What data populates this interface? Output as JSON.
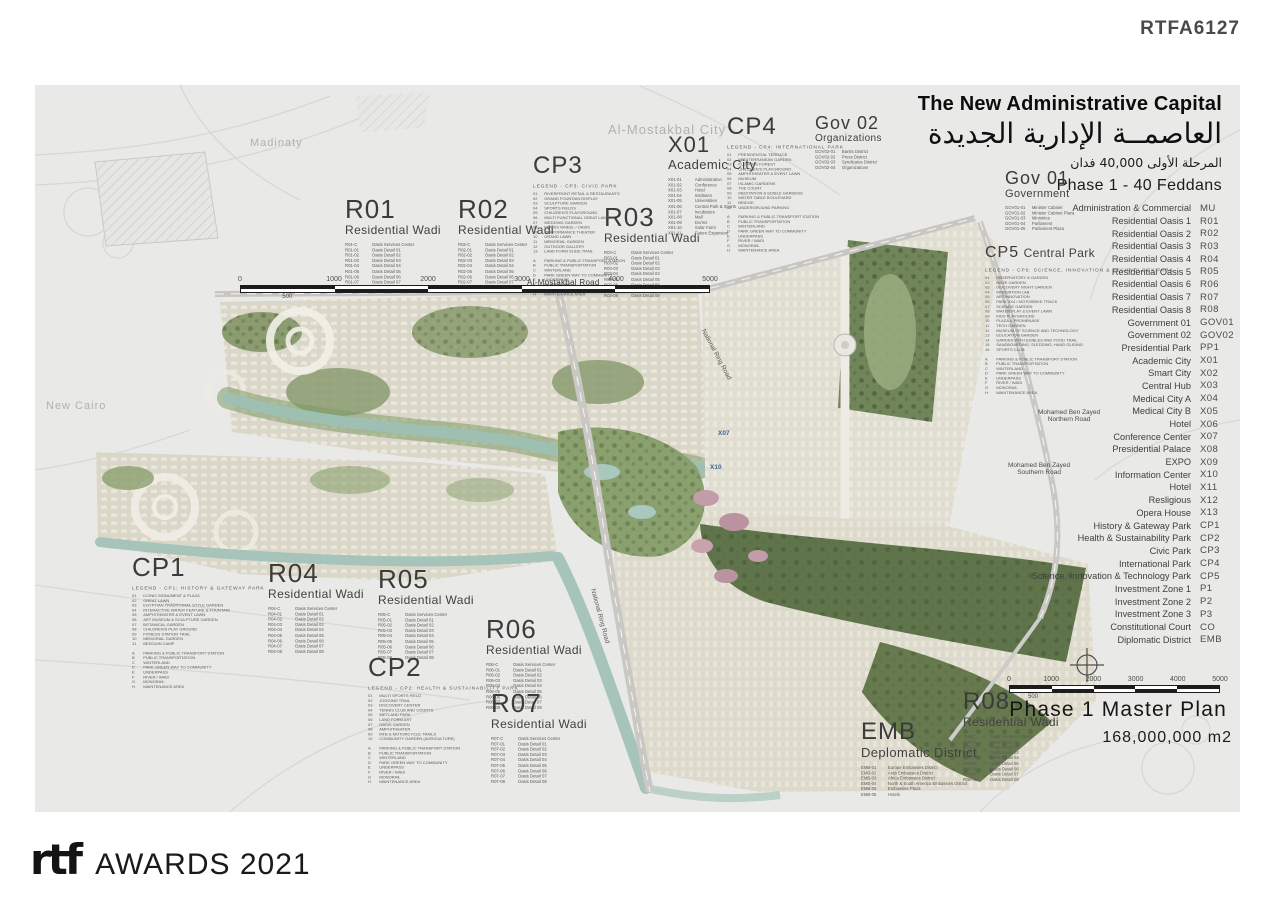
{
  "ref_code": "RTFA6127",
  "title": {
    "en": "The New Administrative Capital",
    "ar": "العاصمــة الإدارية الجديدة",
    "ar_sub": "المرحلة الأولى 40,000 فدان",
    "phase": "Phase 1 - 40 Feddans"
  },
  "context_labels": {
    "madinaty": "Madinaty",
    "almostakbal_city": "Al-Mostakbal City",
    "new_cairo": "New Cairo"
  },
  "roads": {
    "almostakbal_road": "Al-Mostakbal Road",
    "mbz_north_1": "Mohamed Ben Zayed",
    "mbz_north_2": "Northern Road",
    "mbz_south_1": "Mohamed Ben Zayed",
    "mbz_south_2": "Southern Road",
    "national_ring_1": "National Ring Road",
    "national_ring_2": "National Ring Road"
  },
  "map_codes": [
    {
      "label": "X07"
    },
    {
      "label": "X10"
    }
  ],
  "key_legend": [
    {
      "name": "Administration & Commercial",
      "code": "MU"
    },
    {
      "name": "Residential Oasis 1",
      "code": "R01"
    },
    {
      "name": "Residential Oasis 2",
      "code": "R02"
    },
    {
      "name": "Residential Oasis 3",
      "code": "R03"
    },
    {
      "name": "Residential Oasis 4",
      "code": "R04"
    },
    {
      "name": "Residential Oasis 5",
      "code": "R05"
    },
    {
      "name": "Residential Oasis 6",
      "code": "R06"
    },
    {
      "name": "Residential Oasis 7",
      "code": "R07"
    },
    {
      "name": "Residential Oasis 8",
      "code": "R08"
    },
    {
      "name": "Government 01",
      "code": "GOV01"
    },
    {
      "name": "Government 02",
      "code": "GOV02"
    },
    {
      "name": "Presidential Park",
      "code": "PP1"
    },
    {
      "name": "Academic City",
      "code": "X01"
    },
    {
      "name": "Smart City",
      "code": "X02"
    },
    {
      "name": "Central Hub",
      "code": "X03"
    },
    {
      "name": "Medical City A",
      "code": "X04"
    },
    {
      "name": "Medical City B",
      "code": "X05"
    },
    {
      "name": "Hotel",
      "code": "X06"
    },
    {
      "name": "Conference Center",
      "code": "X07"
    },
    {
      "name": "Presidential Palace",
      "code": "X08"
    },
    {
      "name": "EXPO",
      "code": "X09"
    },
    {
      "name": "Information Center",
      "code": "X10"
    },
    {
      "name": "Hotel",
      "code": "X11"
    },
    {
      "name": "Resligious",
      "code": "X12"
    },
    {
      "name": "Opera House",
      "code": "X13"
    },
    {
      "name": "History & Gateway Park",
      "code": "CP1"
    },
    {
      "name": "Health & Sustainability Park",
      "code": "CP2"
    },
    {
      "name": "Civic Park",
      "code": "CP3"
    },
    {
      "name": "International Park",
      "code": "CP4"
    },
    {
      "name": "Science, Innovation & Technology Park",
      "code": "CP5"
    },
    {
      "name": "Investment Zone 1",
      "code": "P1"
    },
    {
      "name": "Investment Zone 2",
      "code": "P2"
    },
    {
      "name": "Investment Zone 3",
      "code": "P3"
    },
    {
      "name": "Constitutional Court",
      "code": "CO"
    },
    {
      "name": "Diplomatic District",
      "code": "EMB"
    }
  ],
  "districts": {
    "r01": {
      "code": "R01",
      "subtitle": "Residential Wadi",
      "items": [
        {
          "c": "R01-C",
          "n": "Oasis Services Center"
        },
        {
          "c": "R01-01",
          "n": "Oasis Detail 01"
        },
        {
          "c": "R01-02",
          "n": "Oasis Detail 02"
        },
        {
          "c": "R01-03",
          "n": "Oasis Detail 03"
        },
        {
          "c": "R01-04",
          "n": "Oasis Detail 04"
        },
        {
          "c": "R01-05",
          "n": "Oasis Detail 05"
        },
        {
          "c": "R01-06",
          "n": "Oasis Detail 06"
        },
        {
          "c": "R01-07",
          "n": "Oasis Detail 07"
        },
        {
          "c": "R01-08",
          "n": "Oasis Detail 08"
        }
      ]
    },
    "r02": {
      "code": "R02",
      "subtitle": "Residential Wadi",
      "items": [
        {
          "c": "R02-C",
          "n": "Oasis Services Center"
        },
        {
          "c": "R02-01",
          "n": "Oasis Detail 01"
        },
        {
          "c": "R02-02",
          "n": "Oasis Detail 02"
        },
        {
          "c": "R02-03",
          "n": "Oasis Detail 03"
        },
        {
          "c": "R02-04",
          "n": "Oasis Detail 04"
        },
        {
          "c": "R02-05",
          "n": "Oasis Detail 05"
        },
        {
          "c": "R02-06",
          "n": "Oasis Detail 06"
        },
        {
          "c": "R02-07",
          "n": "Oasis Detail 07"
        },
        {
          "c": "R02-08",
          "n": "Oasis Detail 08"
        }
      ]
    },
    "r03": {
      "code": "R03",
      "subtitle": "Residential Wadi",
      "items": [
        {
          "c": "R03-C",
          "n": "Oasis Services Center"
        },
        {
          "c": "R03-01",
          "n": "Oasis Detail 01"
        },
        {
          "c": "R03-02",
          "n": "Oasis Detail 02"
        },
        {
          "c": "R03-03",
          "n": "Oasis Detail 03"
        },
        {
          "c": "R03-04",
          "n": "Oasis Detail 04"
        },
        {
          "c": "R03-05",
          "n": "Oasis Detail 05"
        },
        {
          "c": "R03-06",
          "n": "Oasis Detail 06"
        },
        {
          "c": "R03-07",
          "n": "Oasis Detail 07"
        },
        {
          "c": "R03-08",
          "n": "Oasis Detail 08"
        }
      ]
    },
    "r04": {
      "code": "R04",
      "subtitle": "Residential Wadi",
      "items": [
        {
          "c": "R04-C",
          "n": "Oasis Services Center"
        },
        {
          "c": "R04-01",
          "n": "Oasis Detail 01"
        },
        {
          "c": "R04-02",
          "n": "Oasis Detail 02"
        },
        {
          "c": "R04-03",
          "n": "Oasis Detail 03"
        },
        {
          "c": "R04-04",
          "n": "Oasis Detail 04"
        },
        {
          "c": "R04-05",
          "n": "Oasis Detail 05"
        },
        {
          "c": "R04-06",
          "n": "Oasis Detail 06"
        },
        {
          "c": "R04-07",
          "n": "Oasis Detail 07"
        },
        {
          "c": "R04-08",
          "n": "Oasis Detail 08"
        }
      ]
    },
    "r05": {
      "code": "R05",
      "subtitle": "Residential Wadi",
      "items": [
        {
          "c": "R05-C",
          "n": "Oasis Services Center"
        },
        {
          "c": "R05-01",
          "n": "Oasis Detail 01"
        },
        {
          "c": "R05-02",
          "n": "Oasis Detail 02"
        },
        {
          "c": "R05-03",
          "n": "Oasis Detail 03"
        },
        {
          "c": "R05-04",
          "n": "Oasis Detail 04"
        },
        {
          "c": "R05-05",
          "n": "Oasis Detail 05"
        },
        {
          "c": "R05-06",
          "n": "Oasis Detail 06"
        },
        {
          "c": "R05-07",
          "n": "Oasis Detail 07"
        },
        {
          "c": "R05-08",
          "n": "Oasis Detail 08"
        }
      ]
    },
    "r06": {
      "code": "R06",
      "subtitle": "Residential Wadi",
      "items": [
        {
          "c": "R06-C",
          "n": "Oasis Services Center"
        },
        {
          "c": "R06-01",
          "n": "Oasis Detail 01"
        },
        {
          "c": "R06-02",
          "n": "Oasis Detail 02"
        },
        {
          "c": "R06-03",
          "n": "Oasis Detail 03"
        },
        {
          "c": "R06-04",
          "n": "Oasis Detail 04"
        },
        {
          "c": "R06-05",
          "n": "Oasis Detail 05"
        },
        {
          "c": "R06-06",
          "n": "Oasis Detail 06"
        },
        {
          "c": "R06-07",
          "n": "Oasis Detail 07"
        },
        {
          "c": "R06-08",
          "n": "Oasis Detail 08"
        }
      ]
    },
    "r07": {
      "code": "R07",
      "subtitle": "Residential Wadi",
      "items": [
        {
          "c": "R07-C",
          "n": "Oasis Services Center"
        },
        {
          "c": "R07-01",
          "n": "Oasis Detail 01"
        },
        {
          "c": "R07-02",
          "n": "Oasis Detail 02"
        },
        {
          "c": "R07-03",
          "n": "Oasis Detail 03"
        },
        {
          "c": "R07-04",
          "n": "Oasis Detail 04"
        },
        {
          "c": "R07-05",
          "n": "Oasis Detail 05"
        },
        {
          "c": "R07-06",
          "n": "Oasis Detail 06"
        },
        {
          "c": "R07-07",
          "n": "Oasis Detail 07"
        },
        {
          "c": "R07-08",
          "n": "Oasis Detail 08"
        }
      ]
    },
    "r08": {
      "code": "R08",
      "subtitle": "Residential Wadi",
      "items": [
        {
          "c": "R08-C",
          "n": "Oasis Services Center"
        },
        {
          "c": "R08-01",
          "n": "Oasis Detail 01"
        },
        {
          "c": "R08-02",
          "n": "Oasis Detail 02"
        },
        {
          "c": "R08-03",
          "n": "Oasis Detail 03"
        },
        {
          "c": "R08-04",
          "n": "Oasis Detail 04"
        },
        {
          "c": "R08-05",
          "n": "Oasis Detail 05"
        },
        {
          "c": "R08-06",
          "n": "Oasis Detail 06"
        },
        {
          "c": "R08-07",
          "n": "Oasis Detail 07"
        },
        {
          "c": "R08-08",
          "n": "Oasis Detail 08"
        }
      ]
    },
    "x01": {
      "code": "X01",
      "subtitle": "Academic City",
      "items": [
        {
          "c": "X01-01",
          "n": "Administration"
        },
        {
          "c": "X01-02",
          "n": "Conference"
        },
        {
          "c": "X01-03",
          "n": "Hotel"
        },
        {
          "c": "X01-04",
          "n": "Institutes"
        },
        {
          "c": "X01-05",
          "n": "Universities"
        },
        {
          "c": "X01-06",
          "n": "Central Park & Sports"
        },
        {
          "c": "X01-07",
          "n": "Incubators"
        },
        {
          "c": "X01-08",
          "n": "Mall"
        },
        {
          "c": "X01-09",
          "n": "Dorms"
        },
        {
          "c": "X01-10",
          "n": "Solar Farm"
        },
        {
          "c": "X01-11",
          "n": "Future Expansion"
        }
      ]
    },
    "gov01": {
      "code": "Gov 01",
      "subtitle": "Government",
      "items": [
        {
          "c": "GOV01-01",
          "n": "Minister Cabinet"
        },
        {
          "c": "GOV01-02",
          "n": "Minister Cabinet Plaza"
        },
        {
          "c": "GOV01-03",
          "n": "Ministries"
        },
        {
          "c": "GOV01-04",
          "n": "Parliament"
        },
        {
          "c": "GOV01-05",
          "n": "Parliament Plaza"
        }
      ]
    },
    "gov02": {
      "code": "Gov 02",
      "subtitle": "Organizations",
      "items": [
        {
          "c": "GOV02-01",
          "n": "Banks District"
        },
        {
          "c": "GOV02-02",
          "n": "Press District"
        },
        {
          "c": "GOV02-03",
          "n": "Syndicates District"
        },
        {
          "c": "GOV02-04",
          "n": "Organizations"
        }
      ]
    },
    "emb": {
      "code": "EMB",
      "subtitle": "Deplomatic District",
      "items": [
        {
          "c": "EMB-01",
          "n": "Europe Embassies District"
        },
        {
          "c": "EMB-02",
          "n": "Arab Embassies District"
        },
        {
          "c": "EMB-03",
          "n": "Africa Embassies District"
        },
        {
          "c": "EMB-04",
          "n": "North & South America Embassies District"
        },
        {
          "c": "EMB-05",
          "n": "Embassies Plaza"
        },
        {
          "c": "EMB-06",
          "n": "Hotels"
        }
      ]
    }
  },
  "parks": {
    "cp1": {
      "code": "CP1",
      "header": "LEGEND - CP1: HISTORY & GATEWAY PARK",
      "items": [
        {
          "c": "01",
          "n": "ICONIC MONUMENT & PLAZA"
        },
        {
          "c": "02",
          "n": "GREAT LAWN"
        },
        {
          "c": "03",
          "n": "EGYPTIAN TRADITIONAL STYLE GARDEN"
        },
        {
          "c": "04",
          "n": "INTERACTIVE WATER FEATURE & FOUNTAIN"
        },
        {
          "c": "05",
          "n": "AMPHITHEATER & EVENT LAWN"
        },
        {
          "c": "06",
          "n": "ART MUSEUM & SCULPTURE GARDEN"
        },
        {
          "c": "07",
          "n": "BOTANICAL GARDEN"
        },
        {
          "c": "08",
          "n": "CHILDREN'S PLAY GROUND"
        },
        {
          "c": "09",
          "n": "FITNESS STATION TRAIL"
        },
        {
          "c": "10",
          "n": "MEMORIAL GARDEN"
        },
        {
          "c": "11",
          "n": "BEDOUIN CAMP"
        }
      ]
    },
    "cp2": {
      "code": "CP2",
      "header": "LEGEND - CP2: HEALTH & SUSTAINABILITY PARK",
      "items": [
        {
          "c": "01",
          "n": "MULTI SPORTS FIELD"
        },
        {
          "c": "02",
          "n": "JOGGING TRAIL"
        },
        {
          "c": "03",
          "n": "DISCOVERY CENTER"
        },
        {
          "c": "04",
          "n": "TENNIS CLUB AND COURTS"
        },
        {
          "c": "05",
          "n": "WETLAND PARK"
        },
        {
          "c": "06",
          "n": "LAND FORM ART"
        },
        {
          "c": "07",
          "n": "OASIS GARDEN"
        },
        {
          "c": "08",
          "n": "AMPHITHEATER"
        },
        {
          "c": "09",
          "n": "MTB & MOTORCYCLE TRAILS"
        },
        {
          "c": "10",
          "n": "COMMUNITY GARDEN (AGRICULTURE)"
        }
      ]
    },
    "cp3": {
      "code": "CP3",
      "header": "LEGEND - CP3: CIVIC PARK",
      "items": [
        {
          "c": "01",
          "n": "RIVERFRONT RETAIL & RESTAURANTS"
        },
        {
          "c": "02",
          "n": "GRAND FOUNTAIN DISPLAY"
        },
        {
          "c": "03",
          "n": "SCULPTURE GARDEN"
        },
        {
          "c": "04",
          "n": "SPORTS FIELDS"
        },
        {
          "c": "05",
          "n": "CHILDREN'S PLAYGROUND"
        },
        {
          "c": "06",
          "n": "MULTI FUNCTIONAL GREAT LAWN"
        },
        {
          "c": "07",
          "n": "WEDDING GARDEN"
        },
        {
          "c": "08",
          "n": "FERRIS WHEEL / OASIS"
        },
        {
          "c": "09",
          "n": "PERFORMANCE THEATER"
        },
        {
          "c": "10",
          "n": "GRAND LAWN"
        },
        {
          "c": "11",
          "n": "MEMORIAL GARDEN"
        },
        {
          "c": "12",
          "n": "OUTDOOR GALLERY"
        },
        {
          "c": "13",
          "n": "LAND FORM SLIDE TRAIL"
        }
      ]
    },
    "cp4": {
      "code": "CP4",
      "header": "LEGEND - CP4: INTERNATIONAL PARK",
      "items": [
        {
          "c": "01",
          "n": "PRESIDENTIAL TERRACE"
        },
        {
          "c": "02",
          "n": "MEDITERRANEAN GARDEN"
        },
        {
          "c": "03",
          "n": "FLOATING FOREST"
        },
        {
          "c": "04",
          "n": "CHILDREN'S PLAYGROUND"
        },
        {
          "c": "05",
          "n": "AMPHITHEATER & EVENT LAWN"
        },
        {
          "c": "06",
          "n": "MUSEUM"
        },
        {
          "c": "07",
          "n": "ISLAMIC GARDENS"
        },
        {
          "c": "08",
          "n": "THE COURT"
        },
        {
          "c": "09",
          "n": "MEDITATION & EDIBLE GARDENS"
        },
        {
          "c": "10",
          "n": "WATER TABLE BOULEVARD"
        },
        {
          "c": "11",
          "n": "BRIDGE"
        },
        {
          "c": "12",
          "n": "UNDERGROUND PARKING"
        }
      ]
    },
    "cp5": {
      "code": "CP5",
      "subtitle": "Central Park",
      "header": "LEGEND - CP5: SCIENCE, INNOVATION & TECHNOLOGY PARK",
      "items": [
        {
          "c": "01",
          "n": "OBSERVATORY & GARDEN"
        },
        {
          "c": "02",
          "n": "MAZE GARDEN"
        },
        {
          "c": "03",
          "n": "DISCOVERY NIGHT GARDEN"
        },
        {
          "c": "04",
          "n": "INNOVATION LAB"
        },
        {
          "c": "05",
          "n": "ART INNOVATION"
        },
        {
          "c": "06",
          "n": "PARK 4X4 / MOTORBIKE TRACK"
        },
        {
          "c": "07",
          "n": "SCIENCE GARDEN"
        },
        {
          "c": "08",
          "n": "WATER PLAY & EVENT LAWN"
        },
        {
          "c": "09",
          "n": "KIDS PLAYGROUND"
        },
        {
          "c": "10",
          "n": "PLAZA & PROMENADE"
        },
        {
          "c": "11",
          "n": "TECH GARDEN"
        },
        {
          "c": "12",
          "n": "MUSEUM OF SCIENCE AND TECHNOLOGY"
        },
        {
          "c": "13",
          "n": "EDUCATION GARDEN"
        },
        {
          "c": "14",
          "n": "GARDEN WITH EDIBLES AND FOOD TRAIL"
        },
        {
          "c": "15",
          "n": "SANDBOARDING, SLEDDING, HAND GLIDING"
        },
        {
          "c": "16",
          "n": "SPORTS CLUB"
        }
      ]
    }
  },
  "park_common": [
    {
      "c": "A",
      "n": "PARKING & PUBLIC TRANSPORT STATION"
    },
    {
      "c": "B",
      "n": "PUBLIC TRANSPORTATION"
    },
    {
      "c": "C",
      "n": "WINTERLAND"
    },
    {
      "c": "D",
      "n": "PARK GREEN WAY TO COMMUNITY"
    },
    {
      "c": "E",
      "n": "UNDERPASS"
    },
    {
      "c": "F",
      "n": "RIVER / WADI"
    },
    {
      "c": "G",
      "n": "MONORAIL"
    },
    {
      "c": "H",
      "n": "MAINTENANCE AREA"
    }
  ],
  "scalebar": {
    "ticks": [
      "0",
      "1000",
      "2000",
      "3000",
      "4000",
      "5000"
    ],
    "minor": "500"
  },
  "master_plan": {
    "title": "Phase 1 Master Plan",
    "area": "168,000,000 m2"
  },
  "footer": {
    "logo": "rtf",
    "awards": "AWARDS 2021"
  }
}
